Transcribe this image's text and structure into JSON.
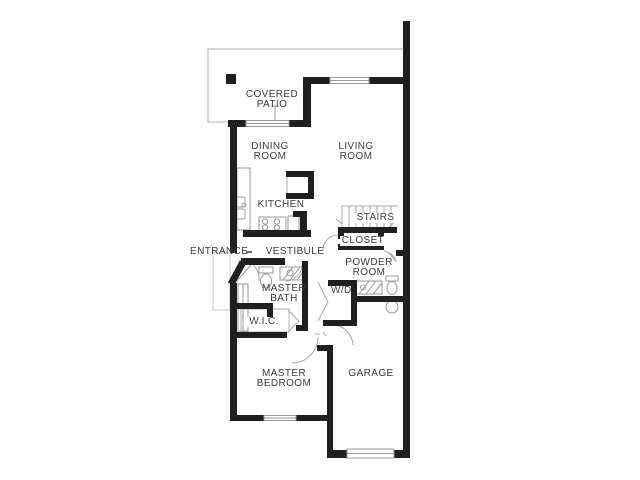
{
  "plan_title": "Floor plan",
  "colors": {
    "background": "#ffffff",
    "wall": "#1f1f1f",
    "thin_line": "#a8a8a8",
    "fixture_line": "#9a9a9a",
    "text": "#3a3a3a"
  },
  "rooms": [
    {
      "id": "covered-patio",
      "label": "COVERED PATIO"
    },
    {
      "id": "dining-room",
      "label": "DINING ROOM"
    },
    {
      "id": "living-room",
      "label": "LIVING ROOM"
    },
    {
      "id": "kitchen",
      "label": "KITCHEN"
    },
    {
      "id": "stairs",
      "label": "STAIRS"
    },
    {
      "id": "entrance",
      "label": "ENTRANCE"
    },
    {
      "id": "vestibule",
      "label": "VESTIBULE"
    },
    {
      "id": "closet",
      "label": "CLOSET"
    },
    {
      "id": "powder-room",
      "label": "POWDER ROOM"
    },
    {
      "id": "master-bath",
      "label": "MASTER BATH"
    },
    {
      "id": "washer-dryer",
      "label": "W/D"
    },
    {
      "id": "walk-in-closet",
      "label": "W.I.C."
    },
    {
      "id": "master-bedroom",
      "label": "MASTER BEDROOM"
    },
    {
      "id": "garage",
      "label": "GARAGE"
    }
  ],
  "fixtures": [
    "kitchen-sink",
    "range-burners",
    "refrigerator",
    "pantry",
    "stairs-treads",
    "front-door",
    "patio-slider-window",
    "living-room-window",
    "dining-room-window",
    "bedroom-window",
    "garage-door",
    "water-heater",
    "toilet",
    "vanity",
    "shower",
    "bifold-doors",
    "door-swing-arcs",
    "entry-walkway"
  ]
}
